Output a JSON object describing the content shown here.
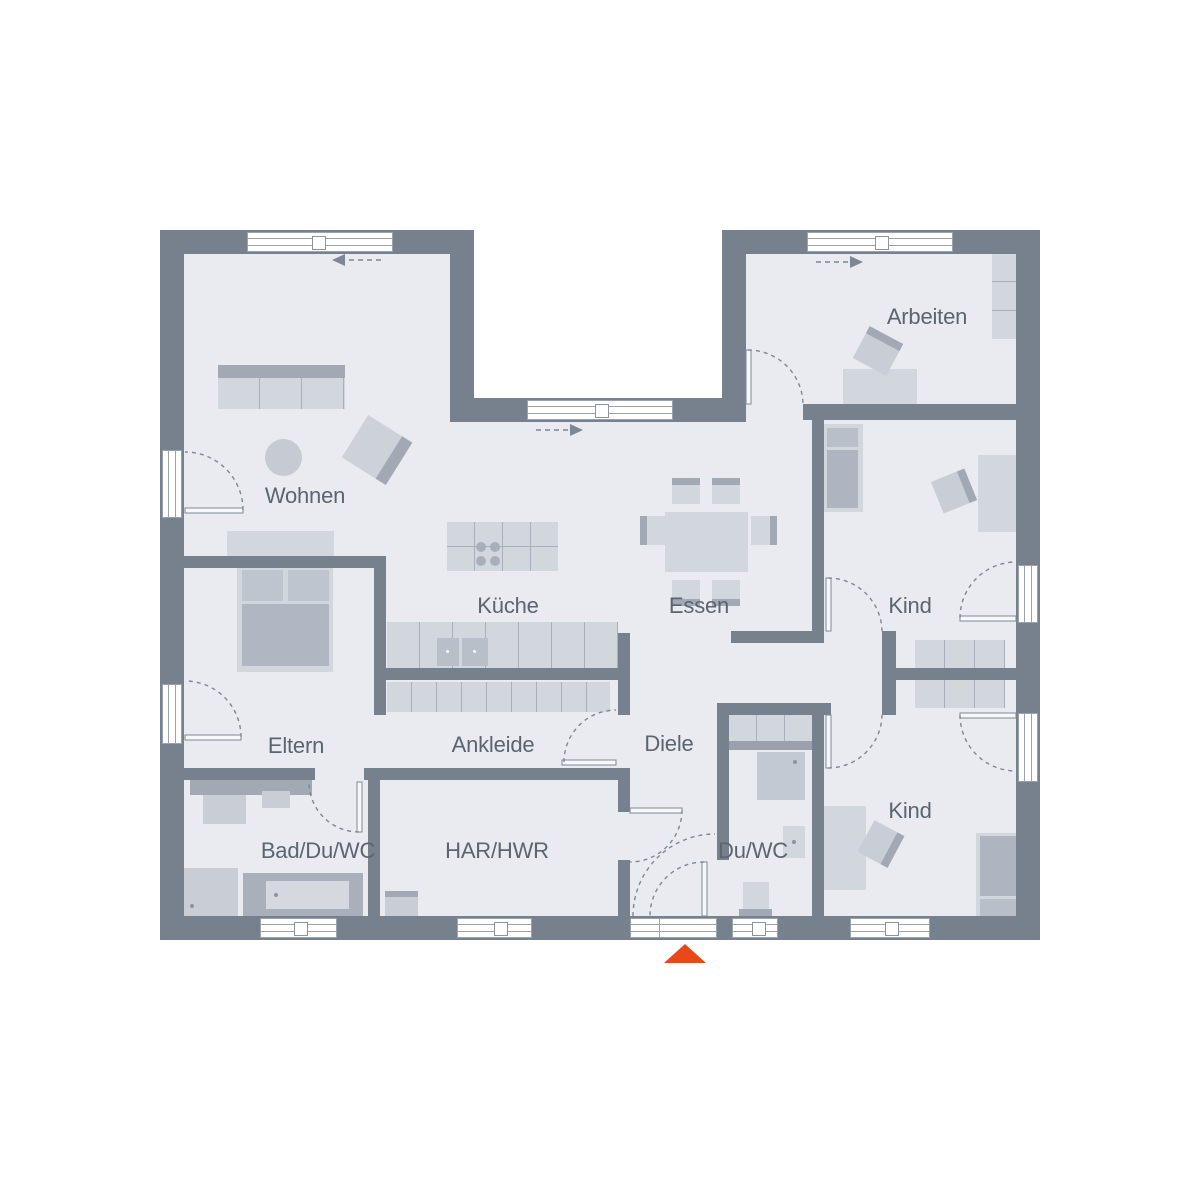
{
  "plan": {
    "title": "Bungalow Grundriss",
    "rooms": [
      {
        "id": "wohnen",
        "label": "Wohnen"
      },
      {
        "id": "arbeiten",
        "label": "Arbeiten"
      },
      {
        "id": "kueche",
        "label": "Küche"
      },
      {
        "id": "essen",
        "label": "Essen"
      },
      {
        "id": "kind1",
        "label": "Kind"
      },
      {
        "id": "eltern",
        "label": "Eltern"
      },
      {
        "id": "ankleide",
        "label": "Ankleide"
      },
      {
        "id": "diele",
        "label": "Diele"
      },
      {
        "id": "bad",
        "label": "Bad/Du/WC"
      },
      {
        "id": "har",
        "label": "HAR/HWR"
      },
      {
        "id": "duwc",
        "label": "Du/WC"
      },
      {
        "id": "kind2",
        "label": "Kind"
      }
    ],
    "entrance_marker": "orange-triangle-up",
    "slide_arrows": [
      "left",
      "right",
      "right"
    ],
    "colors": {
      "wall": "#77818e",
      "floor": "#e9ebf0",
      "furniture_light": "#d2d6dd",
      "furniture_mid": "#c0c6cf",
      "furniture_dark": "#a2a9b4",
      "accent_orange": "#e8481a",
      "label_text": "#5c6470",
      "swing_line": "#7e8794"
    }
  }
}
